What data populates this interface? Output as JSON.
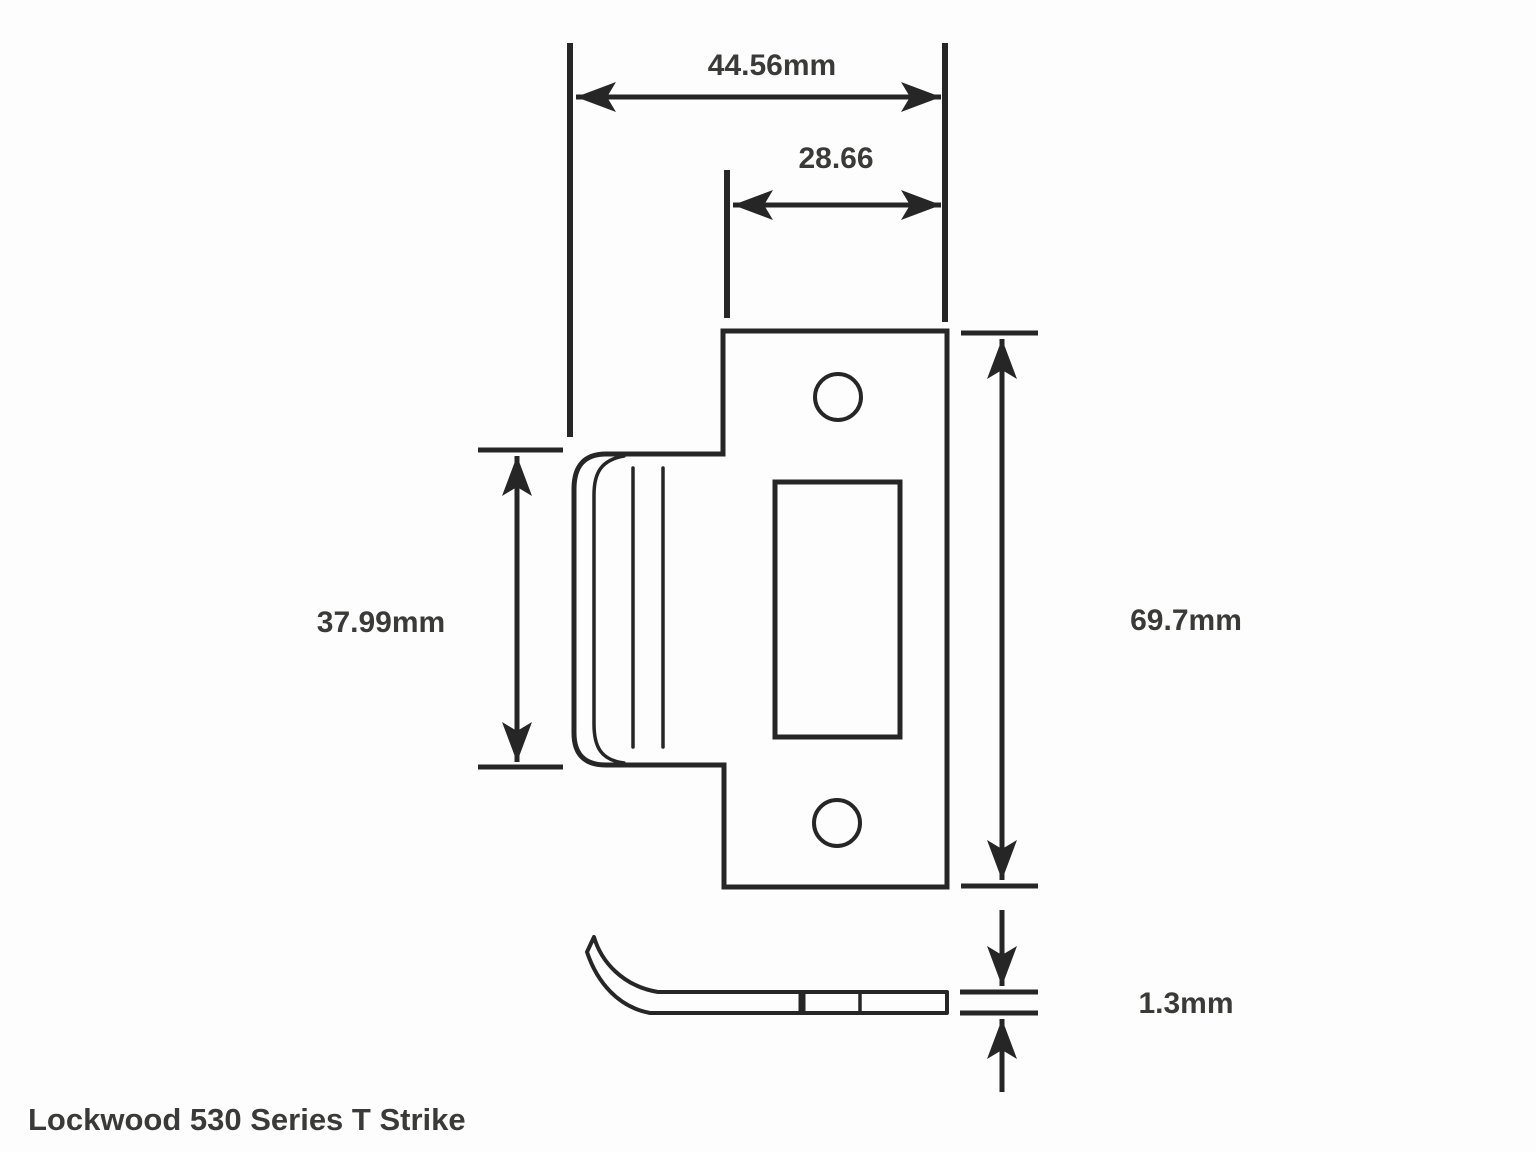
{
  "title": "Lockwood 530 Series T Strike",
  "dimensions": {
    "overall_width": "44.56mm",
    "opening_width": "28.66",
    "tab_height": "37.99mm",
    "plate_height": "69.7mm",
    "thickness": "1.3mm"
  },
  "colors": {
    "line": "#262626",
    "text": "#3a3a38",
    "background": "#fdfdfd"
  }
}
